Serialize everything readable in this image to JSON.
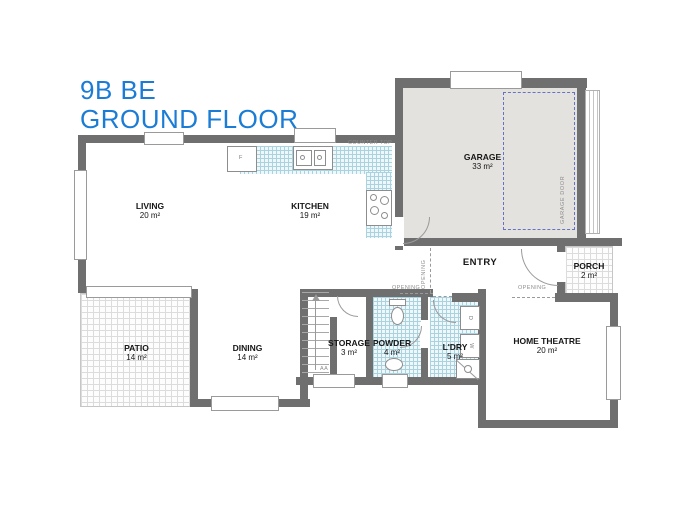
{
  "title": {
    "line1": "9B BE",
    "line2": "GROUND FLOOR"
  },
  "rooms": {
    "living": {
      "name": "LIVING",
      "area": "20 m²"
    },
    "kitchen": {
      "name": "KITCHEN",
      "area": "19 m²"
    },
    "garage": {
      "name": "GARAGE",
      "area": "33 m²"
    },
    "entry": {
      "name": "ENTRY",
      "area": ""
    },
    "porch": {
      "name": "PORCH",
      "area": "2 m²"
    },
    "patio": {
      "name": "PATIO",
      "area": "14 m²"
    },
    "dining": {
      "name": "DINING",
      "area": "14 m²"
    },
    "storage": {
      "name": "STORAGE",
      "area": "3 m²"
    },
    "powder": {
      "name": "POWDER",
      "area": "4 m²"
    },
    "laundry": {
      "name": "L'DRY",
      "area": "5 m²"
    },
    "home_theatre": {
      "name": "HOME THEATRE",
      "area": "20 m²"
    }
  },
  "annotations": {
    "counter_top": "COUNTER TOP",
    "garage_door": "GARAGE DOOR",
    "opening": "OPENING",
    "fridge": "F",
    "window_ref": "AA",
    "dryer": "D",
    "washer": "W"
  },
  "colors": {
    "title_blue": "#1b7cd6",
    "wall_gray": "#6f6f6f",
    "garage_floor": "#e4e2de",
    "wet_area_tile_line": "#abd2df",
    "car_space_dashed": "#6673c5"
  }
}
